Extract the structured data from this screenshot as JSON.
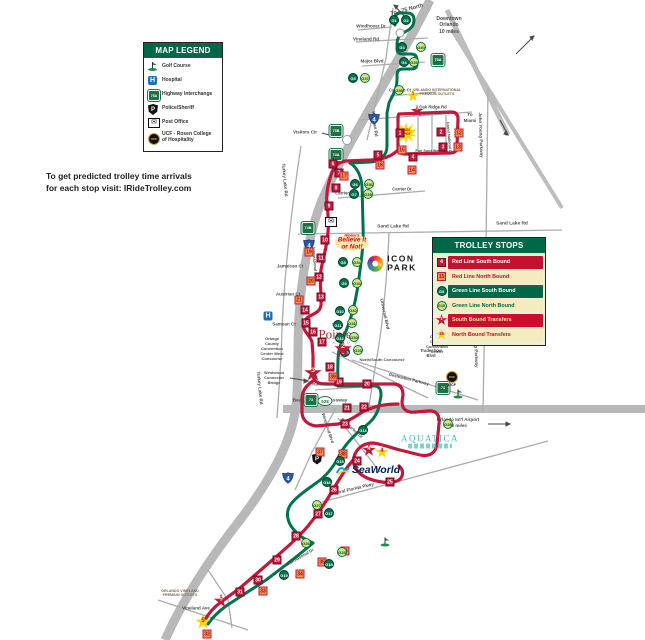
{
  "note": {
    "line1": "To get predicted trolley time arrivals",
    "line2": "for each stop visit:  IRideTrolley.com"
  },
  "map_legend": {
    "title": "MAP LEGEND",
    "items": [
      {
        "icon": "golf-course-icon",
        "label": "Golf Course"
      },
      {
        "icon": "hospital-icon",
        "label": "Hospital"
      },
      {
        "icon": "highway-interchange-icon",
        "label": "Highway Interchange"
      },
      {
        "icon": "police-icon",
        "label": "Police/Sheriff"
      },
      {
        "icon": "post-office-icon",
        "label": "Post Office"
      },
      {
        "icon": "ucf-icon",
        "label": "UCF - Rosen College\nof Hospitality"
      }
    ]
  },
  "trolley_stops_legend": {
    "title": "TROLLEY STOPS",
    "items": [
      {
        "marker": "rs",
        "sample": "4",
        "label": "Red Line South Bound",
        "band_bg": "#c8102e",
        "band_fg": "#ffffff"
      },
      {
        "marker": "rn",
        "sample": "15",
        "label": "Red Line North Bound",
        "band_bg": "#f4ecbe",
        "band_fg": "#c8102e"
      },
      {
        "marker": "gs",
        "sample": "G9",
        "label": "Green Line South Bound",
        "band_bg": "#006747",
        "band_fg": "#ffffff"
      },
      {
        "marker": "gn",
        "sample": "G15",
        "label": "Green Line North Bound",
        "band_bg": "#f4ecbe",
        "band_fg": "#006747"
      },
      {
        "marker": "ts",
        "sample": "1",
        "label": "South Bound Transfers",
        "band_bg": "#c8102e",
        "band_fg": "#ffe89a"
      },
      {
        "marker": "tn",
        "sample": "15",
        "label": "North Bound Transfers",
        "band_bg": "#f4ecbe",
        "band_fg": "#c8102e"
      }
    ]
  },
  "colors": {
    "red_line": "#c2183c",
    "green_line": "#00734d",
    "legend_green": "#006747",
    "road_gray": "#b8b8b8"
  },
  "road_labels": [
    {
      "text": "To I-75 North",
      "x": 407,
      "y": 10,
      "r": -15,
      "s": 5.5
    },
    {
      "text": "Windhover Dr",
      "x": 371,
      "y": 26,
      "s": 4.5
    },
    {
      "text": "Vineland Rd",
      "x": 366,
      "y": 39,
      "s": 4.5
    },
    {
      "text": "Major Blvd",
      "x": 372,
      "y": 61,
      "s": 4.5
    },
    {
      "text": "Kirkman Rd",
      "x": 375,
      "y": 124,
      "r": 83,
      "s": 4.5
    },
    {
      "text": "Caravan Ct",
      "x": 400,
      "y": 90,
      "s": 4.2
    },
    {
      "text": "Oak Ridge Rd",
      "x": 433,
      "y": 107,
      "s": 4.2
    },
    {
      "text": "Fun Spot Way",
      "x": 428,
      "y": 151,
      "s": 3.8
    },
    {
      "text": "Grand National Dr",
      "x": 449,
      "y": 138,
      "r": 85,
      "s": 3.8
    },
    {
      "text": "John Young Parkway",
      "x": 481,
      "y": 135,
      "r": 88,
      "s": 4.5
    },
    {
      "text": "John Young Parkway",
      "x": 476,
      "y": 345,
      "r": 88,
      "s": 4.5
    },
    {
      "text": "Visitors Cir",
      "x": 305,
      "y": 132,
      "s": 4.5
    },
    {
      "text": "Turkey Lake Rd",
      "x": 285,
      "y": 180,
      "r": 85,
      "s": 4.5
    },
    {
      "text": "Turkey Lake Rd",
      "x": 260,
      "y": 388,
      "r": 85,
      "s": 4.5
    },
    {
      "text": "Sand Lake Rd",
      "x": 393,
      "y": 227,
      "s": 4.8
    },
    {
      "text": "Sand Lake Rd",
      "x": 512,
      "y": 224,
      "s": 4.8
    },
    {
      "text": "Carrier Dr",
      "x": 345,
      "y": 193,
      "s": 4.2
    },
    {
      "text": "Carrier Dr",
      "x": 402,
      "y": 189,
      "s": 4.2
    },
    {
      "text": "International Dr",
      "x": 315,
      "y": 262,
      "r": 85,
      "s": 4
    },
    {
      "text": "Jamaican Ct",
      "x": 290,
      "y": 266,
      "s": 4.5
    },
    {
      "text": "Austrian Ct",
      "x": 288,
      "y": 294,
      "s": 4.5
    },
    {
      "text": "Samoan Ct",
      "x": 284,
      "y": 324,
      "s": 4.5
    },
    {
      "text": "Hawaiian Ct",
      "x": 325,
      "y": 384,
      "s": 4.5
    },
    {
      "text": "Universal Blvd",
      "x": 385,
      "y": 314,
      "r": 78,
      "s": 4.5
    },
    {
      "text": "Destination Parkway",
      "x": 409,
      "y": 379,
      "r": 14,
      "s": 4.2
    },
    {
      "text": "Beach Line Expressway",
      "x": 320,
      "y": 401,
      "s": 4.8
    },
    {
      "text": "Central Florida Pkwy",
      "x": 352,
      "y": 489,
      "r": -13,
      "s": 4.5
    },
    {
      "text": "Sea Harbor Dr",
      "x": 352,
      "y": 428,
      "r": 42,
      "s": 4.2
    },
    {
      "text": "Westwood Blvd",
      "x": 328,
      "y": 428,
      "r": 72,
      "s": 4.2
    },
    {
      "text": "International Dr",
      "x": 300,
      "y": 557,
      "r": -30,
      "s": 4.2
    },
    {
      "text": "Vineland Ave",
      "x": 196,
      "y": 608,
      "s": 4.5
    }
  ],
  "label_blocks": [
    {
      "name": "downtown-note",
      "lines": [
        "Downtown",
        "Orlando",
        "10 miles"
      ],
      "x": 449,
      "y": 16,
      "s": 5,
      "c": "#4a4a4a"
    },
    {
      "name": "to-miami-note",
      "lines": [
        "To",
        "Miami"
      ],
      "x": 470,
      "y": 112,
      "s": 4.5,
      "c": "#4a4a4a"
    },
    {
      "name": "premium-outlets-north",
      "lines": [
        "ORLANDO INTERNATIONAL",
        "PREMIUM OUTLETS"
      ],
      "x": 437,
      "y": 88,
      "s": 3.6,
      "c": "#7a6a52"
    },
    {
      "name": "occc-west",
      "lines": [
        "Orange",
        "County",
        "Convention",
        "Center West",
        "Concourse"
      ],
      "x": 272,
      "y": 336,
      "s": 4,
      "c": "#4a4a4a"
    },
    {
      "name": "occc-north-south",
      "lines": [
        "Orange",
        "County",
        "Convention",
        "Center"
      ],
      "x": 437,
      "y": 334,
      "s": 4,
      "c": "#4a4a4a"
    },
    {
      "name": "occc-ns-concourse",
      "lines": [
        "North/South Concourse"
      ],
      "x": 382,
      "y": 357,
      "s": 4,
      "c": "#4a4a4a"
    },
    {
      "name": "westwood-bridge",
      "lines": [
        "Westwood",
        "Connector",
        "Bridge"
      ],
      "x": 274,
      "y": 370,
      "s": 4,
      "c": "#4a4a4a"
    },
    {
      "name": "airport-note",
      "lines": [
        "Orlando Int'l  Airport",
        "12 miles"
      ],
      "x": 458,
      "y": 417,
      "s": 4.5,
      "c": "#4a4a4a"
    },
    {
      "name": "tradeshow-blvd",
      "lines": [
        "Tradeshow",
        "Blvd"
      ],
      "x": 431,
      "y": 348,
      "s": 4.2,
      "c": "#4a4a4a"
    },
    {
      "name": "premium-outlets-south",
      "lines": [
        "ORLANDO VINELAND",
        "PREMIUM OUTLETS"
      ],
      "x": 180,
      "y": 589,
      "s": 3.6,
      "c": "#7a6a52"
    }
  ],
  "stops": [
    {
      "t": "rs",
      "n": "1",
      "x": 400,
      "y": 133
    },
    {
      "t": "rs",
      "n": "2",
      "x": 441,
      "y": 132
    },
    {
      "t": "rs",
      "n": "3",
      "x": 443,
      "y": 147
    },
    {
      "t": "rs",
      "n": "4",
      "x": 413,
      "y": 157
    },
    {
      "t": "rs",
      "n": "5",
      "x": 378,
      "y": 155
    },
    {
      "t": "rs",
      "n": "6",
      "x": 333,
      "y": 164
    },
    {
      "t": "rs",
      "n": "7",
      "x": 339,
      "y": 173
    },
    {
      "t": "rs",
      "n": "8",
      "x": 336,
      "y": 188
    },
    {
      "t": "rs",
      "n": "9",
      "x": 329,
      "y": 206
    },
    {
      "t": "rs",
      "n": "10",
      "x": 325,
      "y": 240
    },
    {
      "t": "rs",
      "n": "11",
      "x": 321,
      "y": 258
    },
    {
      "t": "rs",
      "n": "12",
      "x": 319,
      "y": 277
    },
    {
      "t": "rs",
      "n": "13",
      "x": 321,
      "y": 297
    },
    {
      "t": "rs",
      "n": "14",
      "x": 305,
      "y": 310
    },
    {
      "t": "rs",
      "n": "15",
      "x": 306,
      "y": 323
    },
    {
      "t": "rs",
      "n": "16",
      "x": 313,
      "y": 332
    },
    {
      "t": "rs",
      "n": "17",
      "x": 322,
      "y": 342
    },
    {
      "t": "rs",
      "n": "18",
      "x": 330,
      "y": 367
    },
    {
      "t": "rs",
      "n": "19",
      "x": 339,
      "y": 382
    },
    {
      "t": "rs",
      "n": "20",
      "x": 367,
      "y": 384
    },
    {
      "t": "rs",
      "n": "21",
      "x": 347,
      "y": 408
    },
    {
      "t": "rs",
      "n": "22",
      "x": 364,
      "y": 407
    },
    {
      "t": "rs",
      "n": "23",
      "x": 345,
      "y": 424
    },
    {
      "t": "rs",
      "n": "24",
      "x": 357,
      "y": 461
    },
    {
      "t": "rs",
      "n": "25",
      "x": 390,
      "y": 482
    },
    {
      "t": "rs",
      "n": "26",
      "x": 334,
      "y": 490
    },
    {
      "t": "rs",
      "n": "27",
      "x": 318,
      "y": 514
    },
    {
      "t": "rs",
      "n": "28",
      "x": 296,
      "y": 536
    },
    {
      "t": "rs",
      "n": "29",
      "x": 277,
      "y": 560
    },
    {
      "t": "rs",
      "n": "30",
      "x": 258,
      "y": 580
    },
    {
      "t": "rs",
      "n": "31",
      "x": 240,
      "y": 592
    },
    {
      "t": "rn",
      "n": "12",
      "x": 459,
      "y": 133
    },
    {
      "t": "rn",
      "n": "13",
      "x": 458,
      "y": 147
    },
    {
      "t": "rn",
      "n": "14",
      "x": 412,
      "y": 170
    },
    {
      "t": "rn",
      "n": "15",
      "x": 402,
      "y": 150
    },
    {
      "t": "rn",
      "n": "16",
      "x": 380,
      "y": 165
    },
    {
      "t": "rn",
      "n": "17",
      "x": 344,
      "y": 176
    },
    {
      "t": "rn",
      "n": "19",
      "x": 309,
      "y": 252
    },
    {
      "t": "rn",
      "n": "20",
      "x": 311,
      "y": 281
    },
    {
      "t": "rn",
      "n": "21",
      "x": 299,
      "y": 300
    },
    {
      "t": "rn",
      "n": "39",
      "x": 333,
      "y": 377
    },
    {
      "t": "rn",
      "n": "37",
      "x": 320,
      "y": 452
    },
    {
      "t": "rn",
      "n": "38",
      "x": 343,
      "y": 454
    },
    {
      "t": "rn",
      "n": "33",
      "x": 263,
      "y": 591
    },
    {
      "t": "rn",
      "n": "34",
      "x": 300,
      "y": 574
    },
    {
      "t": "rn",
      "n": "35",
      "x": 322,
      "y": 562
    },
    {
      "t": "rn",
      "n": "36",
      "x": 345,
      "y": 551
    },
    {
      "t": "rn",
      "n": "32",
      "x": 207,
      "y": 634
    },
    {
      "t": "gs",
      "n": "G1",
      "x": 394,
      "y": 20
    },
    {
      "t": "gs",
      "n": "G2",
      "x": 406,
      "y": 20
    },
    {
      "t": "gs",
      "n": "G3",
      "x": 402,
      "y": 47
    },
    {
      "t": "gs",
      "n": "G4",
      "x": 404,
      "y": 62
    },
    {
      "t": "gs",
      "n": "G5",
      "x": 353,
      "y": 78
    },
    {
      "t": "gs",
      "n": "G6",
      "x": 355,
      "y": 184
    },
    {
      "t": "gs",
      "n": "G7",
      "x": 354,
      "y": 194
    },
    {
      "t": "gs",
      "n": "G8",
      "x": 343,
      "y": 262
    },
    {
      "t": "gs",
      "n": "G9",
      "x": 344,
      "y": 283
    },
    {
      "t": "gs",
      "n": "G10",
      "x": 340,
      "y": 311
    },
    {
      "t": "gs",
      "n": "G11",
      "x": 338,
      "y": 325
    },
    {
      "t": "gs",
      "n": "G12",
      "x": 340,
      "y": 338
    },
    {
      "t": "gs",
      "n": "G13",
      "x": 345,
      "y": 352
    },
    {
      "t": "gs",
      "n": "G14",
      "x": 363,
      "y": 430
    },
    {
      "t": "gs",
      "n": "G15",
      "x": 340,
      "y": 461
    },
    {
      "t": "gs",
      "n": "G16",
      "x": 327,
      "y": 482
    },
    {
      "t": "gs",
      "n": "G17",
      "x": 329,
      "y": 513
    },
    {
      "t": "gs",
      "n": "G18",
      "x": 329,
      "y": 564
    },
    {
      "t": "gs",
      "n": "G19",
      "x": 284,
      "y": 575
    },
    {
      "t": "gn",
      "n": "G40",
      "x": 421,
      "y": 47
    },
    {
      "t": "gn",
      "n": "G39",
      "x": 414,
      "y": 62
    },
    {
      "t": "gn",
      "n": "G38",
      "x": 399,
      "y": 90
    },
    {
      "t": "gn",
      "n": "G37",
      "x": 365,
      "y": 78
    },
    {
      "t": "gn",
      "n": "G36",
      "x": 369,
      "y": 184
    },
    {
      "t": "gn",
      "n": "G35",
      "x": 368,
      "y": 194
    },
    {
      "t": "gn",
      "n": "G34",
      "x": 357,
      "y": 262
    },
    {
      "t": "gn",
      "n": "G33",
      "x": 357,
      "y": 283
    },
    {
      "t": "gn",
      "n": "G32",
      "x": 353,
      "y": 310
    },
    {
      "t": "gn",
      "n": "G31",
      "x": 352,
      "y": 323
    },
    {
      "t": "gn",
      "n": "G30",
      "x": 354,
      "y": 337
    },
    {
      "t": "gn",
      "n": "G29",
      "x": 358,
      "y": 350
    },
    {
      "t": "gn",
      "n": "G28",
      "x": 448,
      "y": 424
    },
    {
      "t": "gn",
      "n": "G27",
      "x": 317,
      "y": 505
    },
    {
      "t": "gn",
      "n": "G26",
      "x": 306,
      "y": 543
    },
    {
      "t": "gn",
      "n": "G25",
      "x": 342,
      "y": 552
    }
  ],
  "transfers": [
    {
      "t": "ts",
      "n": "1",
      "x": 417,
      "y": 111,
      "size": 13
    },
    {
      "t": "tn",
      "n": "1",
      "x": 413,
      "y": 96,
      "size": 13
    },
    {
      "t": "ts",
      "n": "2",
      "x": 343,
      "y": 349,
      "size": 18
    },
    {
      "t": "ts",
      "n": "3",
      "x": 313,
      "y": 373,
      "size": 18
    },
    {
      "t": "ts",
      "n": "4",
      "x": 369,
      "y": 450,
      "size": 14
    },
    {
      "t": "tn",
      "n": "4",
      "x": 382,
      "y": 452,
      "size": 14
    },
    {
      "t": "ts",
      "n": "5",
      "x": 221,
      "y": 601,
      "size": 15
    },
    {
      "t": "tn",
      "n": "5",
      "x": 203,
      "y": 622,
      "size": 16
    }
  ],
  "highway_shields": [
    {
      "kind": "i4",
      "n": "4",
      "x": 374,
      "y": 121
    },
    {
      "kind": "i4",
      "n": "4",
      "x": 309,
      "y": 247
    },
    {
      "kind": "i4",
      "n": "4",
      "x": 288,
      "y": 480
    },
    {
      "kind": "green",
      "n": "75A",
      "x": 438,
      "y": 60
    },
    {
      "kind": "green",
      "n": "75B",
      "x": 336,
      "y": 131
    },
    {
      "kind": "green",
      "n": "74A",
      "x": 336,
      "y": 155
    },
    {
      "kind": "green",
      "n": "74B",
      "x": 308,
      "y": 228
    },
    {
      "kind": "green",
      "n": "73",
      "x": 311,
      "y": 400
    },
    {
      "kind": "green",
      "n": "71",
      "x": 443,
      "y": 388
    },
    {
      "kind": "oval",
      "n": "528",
      "x": 325,
      "y": 401
    }
  ],
  "pois": [
    {
      "kind": "hospital",
      "x": 268,
      "y": 316
    },
    {
      "kind": "police",
      "x": 317,
      "y": 459
    },
    {
      "kind": "post",
      "x": 331,
      "y": 222
    },
    {
      "kind": "golf",
      "x": 458,
      "y": 394
    },
    {
      "kind": "golf",
      "x": 385,
      "y": 542
    },
    {
      "kind": "ucf",
      "x": 452,
      "y": 379
    },
    {
      "kind": "circle",
      "x": 347,
      "y": 140,
      "d": 8
    },
    {
      "kind": "circle",
      "x": 400,
      "y": 33,
      "d": 7
    }
  ],
  "logos": {
    "funspot": {
      "text": "FUN\nSPOT",
      "x": 406,
      "y": 133
    },
    "ripleys": {
      "line1": "Ripley's",
      "line2": "Believe It",
      "line3": "or Not!",
      "x": 352,
      "y": 242
    },
    "iconpark": {
      "line1": "ICON",
      "line2": "PARK",
      "x": 392,
      "y": 264
    },
    "pointe": {
      "the": "the",
      "main": "Pointe",
      "sub": "O R L A N D O",
      "x": 335,
      "y": 334
    },
    "seaworld": {
      "text": "SeaWorld",
      "x": 368,
      "y": 470
    },
    "aquatica": {
      "text": "AQUATICA",
      "x": 430,
      "y": 441
    },
    "ucf_label": "UCF",
    "oval_528": "528"
  }
}
